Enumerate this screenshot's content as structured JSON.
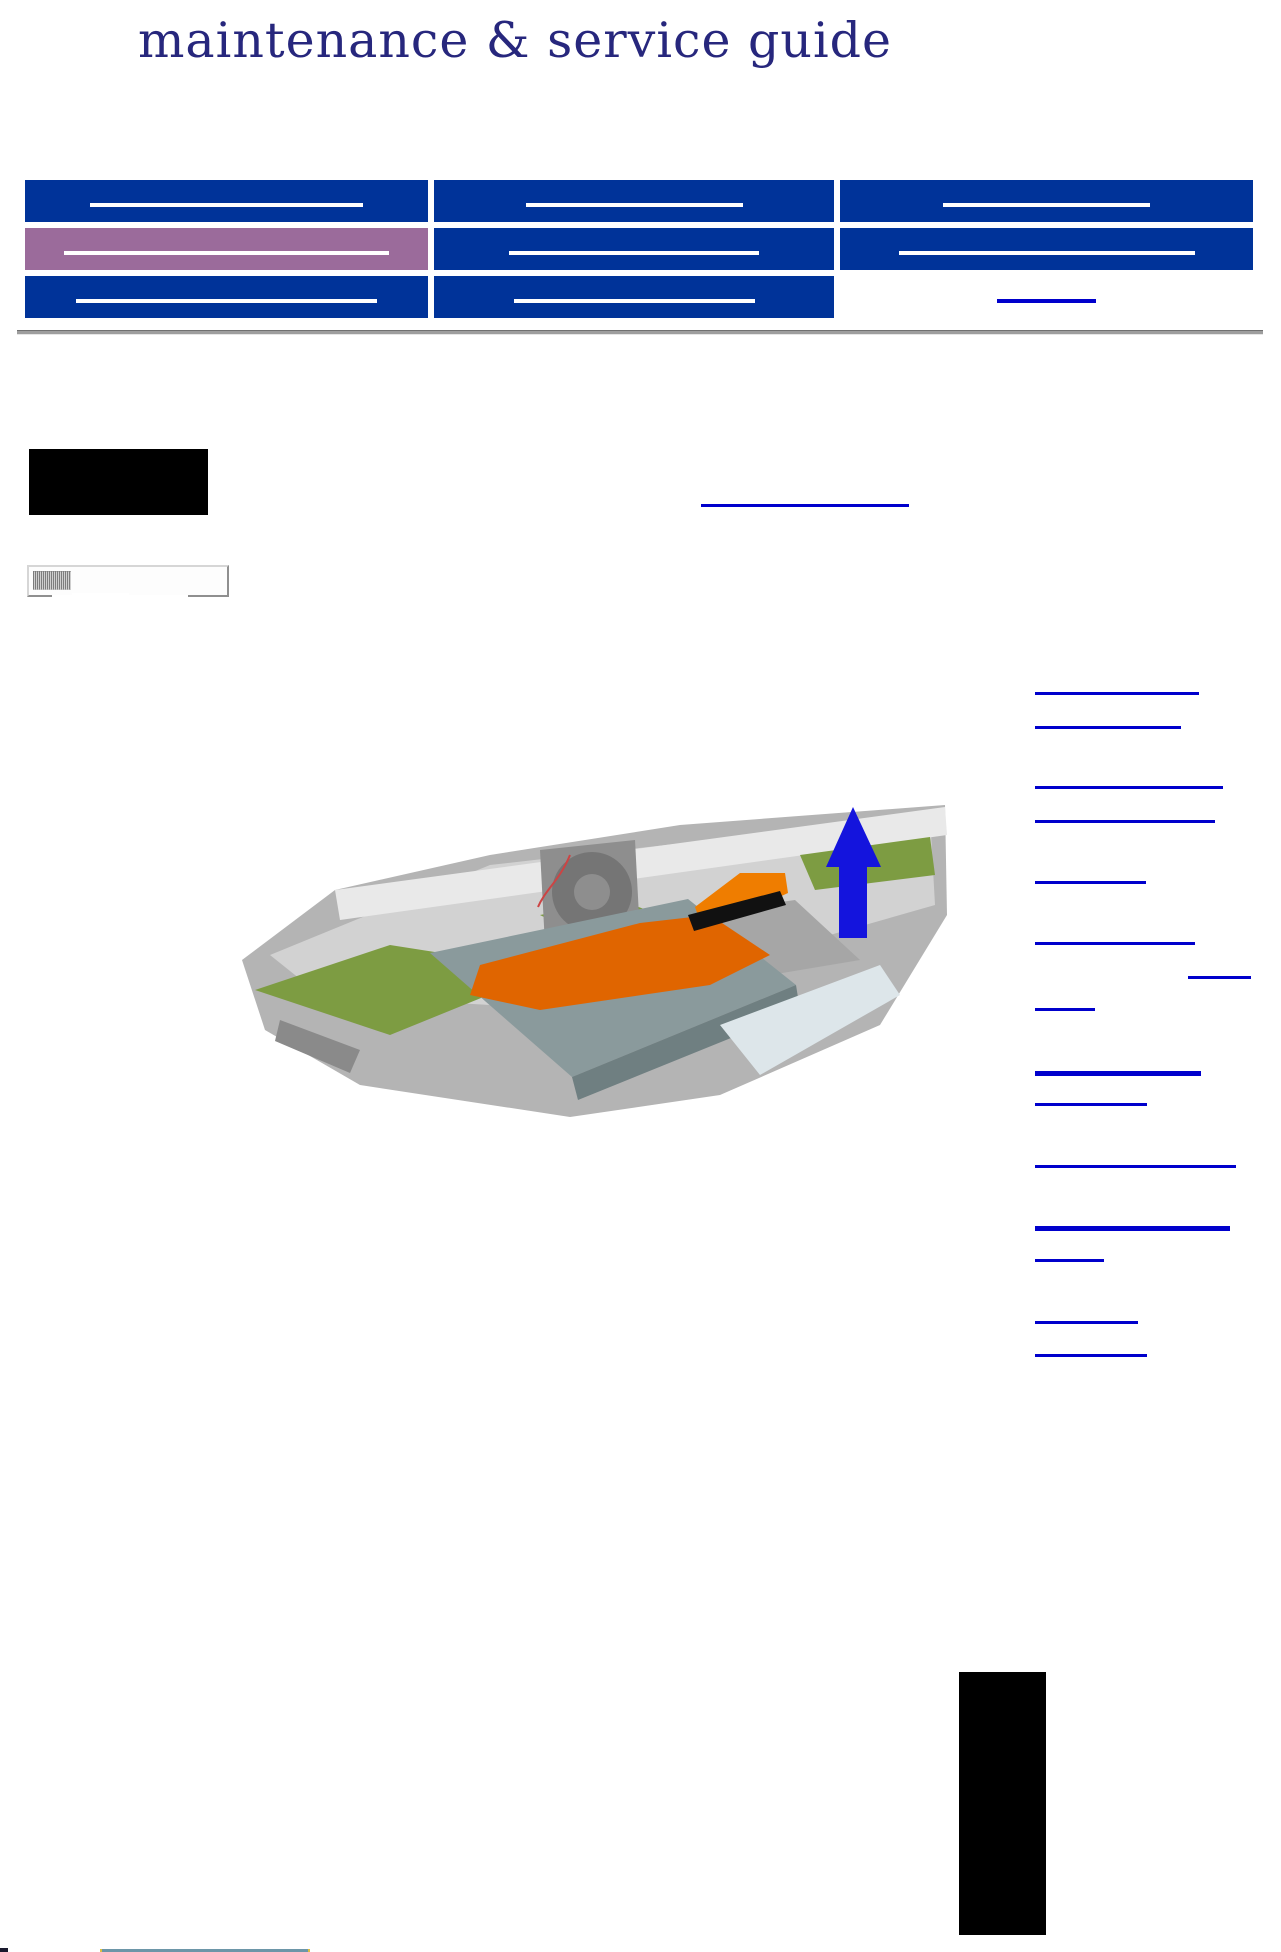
{
  "page": {
    "title": "maintenance & service guide",
    "title_color": "#27277d",
    "background": "#ffffff"
  },
  "colors": {
    "nav_blue": "#003399",
    "nav_purple": "#9b6b9b",
    "sidebar_purple": "#9b6b9b",
    "highlight_yellow": "#ffff66",
    "link_blue": "#0000cc",
    "underline_white": "#ffffff",
    "rule_gray": "#9e9e9e",
    "placeholder_black": "#000000"
  },
  "nav": {
    "col_widths": [
      403,
      400,
      413
    ],
    "row_height": 42,
    "rows": [
      {
        "cells": [
          {
            "bg": "#003399",
            "underline_color": "#ffffff",
            "underline_w": 273
          },
          {
            "bg": "#003399",
            "underline_color": "#ffffff",
            "underline_w": 217
          },
          {
            "bg": "#003399",
            "underline_color": "#ffffff",
            "underline_w": 207
          }
        ]
      },
      {
        "cells": [
          {
            "bg": "#9b6b9b",
            "underline_color": "#ffffff",
            "underline_w": 325
          },
          {
            "bg": "#003399",
            "underline_color": "#ffffff",
            "underline_w": 250
          },
          {
            "bg": "#003399",
            "underline_color": "#ffffff",
            "underline_w": 296
          }
        ]
      },
      {
        "cells": [
          {
            "bg": "#003399",
            "underline_color": "#ffffff",
            "underline_w": 301
          },
          {
            "bg": "#003399",
            "underline_color": "#ffffff",
            "underline_w": 241
          },
          {
            "bg": "transparent",
            "underline_color": "#0000cc",
            "underline_w": 99
          }
        ]
      }
    ]
  },
  "header_note": {
    "black_box": {
      "x": 29,
      "y": 449,
      "w": 179,
      "h": 66
    },
    "link": {
      "x": 701,
      "y": 504,
      "w": 208,
      "h": 3
    }
  },
  "sidebar": {
    "x": 27,
    "y": 565,
    "width": 202,
    "cells": [
      {
        "bg": "#ffffff",
        "h": 64,
        "underlines": []
      },
      {
        "bg": "#9b6b9b",
        "h": 72,
        "underlines": [
          {
            "o": 27,
            "w": 156
          },
          {
            "o": 59,
            "w": 152
          }
        ]
      },
      {
        "bg": "#9b6b9b",
        "h": 39,
        "underlines": [
          {
            "o": 26,
            "w": 173
          }
        ]
      },
      {
        "bg": "#9b6b9b",
        "h": 104,
        "underlines": [
          {
            "o": 26,
            "w": 128
          },
          {
            "o": 58,
            "w": 153
          },
          {
            "o": 91,
            "w": 141
          }
        ]
      },
      {
        "bg": "#9b6b9b",
        "h": 40,
        "underlines": [
          {
            "o": 26,
            "w": 183
          }
        ]
      },
      {
        "bg": "#9b6b9b",
        "h": 36,
        "underlines": [
          {
            "o": 23,
            "w": 130
          }
        ]
      },
      {
        "bg": "#9b6b9b",
        "h": 37,
        "underlines": [
          {
            "o": 23,
            "w": 134
          }
        ]
      },
      {
        "bg": "#9b6b9b",
        "h": 38,
        "underlines": [
          {
            "o": 25,
            "w": 146
          }
        ]
      },
      {
        "bg": "#9b6b9b",
        "h": 71,
        "underlines": [
          {
            "o": 25,
            "w": 104
          },
          {
            "o": 57,
            "w": 118
          }
        ]
      },
      {
        "bg": "#9b6b9b",
        "h": 105,
        "underlines": [
          {
            "o": 27,
            "w": 109
          },
          {
            "o": 59,
            "w": 115
          },
          {
            "o": 92,
            "w": 80
          }
        ]
      },
      {
        "bg": "#9b6b9b",
        "h": 38,
        "underlines": [
          {
            "o": 26,
            "w": 97
          }
        ]
      },
      {
        "bg": "#9b6b9b",
        "h": 72,
        "underlines": [
          {
            "o": 26,
            "w": 185
          },
          {
            "o": 59,
            "w": 129
          }
        ]
      },
      {
        "bg": "#9b6b9b",
        "h": 72,
        "underlines": [
          {
            "o": 26,
            "w": 152
          },
          {
            "o": 59,
            "w": 77
          }
        ]
      },
      {
        "bg": "#9b6b9b",
        "h": 71,
        "underlines": [
          {
            "o": 26,
            "w": 118
          },
          {
            "o": 58,
            "w": 129
          }
        ]
      },
      {
        "bg": "#ffff66",
        "h": 65,
        "underlines": []
      },
      {
        "bg": "#9b6b9b",
        "h": 67,
        "underlines": [
          {
            "o": 21,
            "w": 57
          },
          {
            "o": 55,
            "w": 129
          }
        ]
      },
      {
        "bg": "#9b6b9b",
        "h": 71,
        "underlines": [
          {
            "o": 24,
            "w": 107
          },
          {
            "o": 58,
            "w": 80
          }
        ]
      },
      {
        "bg": "#9b6b9b",
        "h": 70,
        "underlines": [
          {
            "o": 26,
            "w": 152
          },
          {
            "o": 58,
            "w": 111
          }
        ]
      },
      {
        "bg": "#9b6b9b",
        "h": 74,
        "underlines": [
          {
            "o": 27,
            "w": 117
          },
          {
            "o": 60,
            "w": 97
          }
        ]
      }
    ]
  },
  "right_links": {
    "default_x": 1035,
    "items": [
      {
        "y": 692,
        "w": 164,
        "h": 3
      },
      {
        "y": 726,
        "w": 146,
        "h": 3
      },
      {
        "y": 786,
        "w": 188,
        "h": 3
      },
      {
        "y": 820,
        "w": 180,
        "h": 3
      },
      {
        "y": 881,
        "w": 111,
        "h": 3
      },
      {
        "y": 942,
        "w": 160,
        "h": 3
      },
      {
        "y": 976,
        "w": 63,
        "h": 3,
        "x": 1188
      },
      {
        "y": 1008,
        "w": 60,
        "h": 3
      },
      {
        "y": 1071,
        "w": 166,
        "h": 5
      },
      {
        "y": 1103,
        "w": 112,
        "h": 3
      },
      {
        "y": 1165,
        "w": 201,
        "h": 3
      },
      {
        "y": 1226,
        "w": 195,
        "h": 5
      },
      {
        "y": 1259,
        "w": 69,
        "h": 3
      },
      {
        "y": 1321,
        "w": 103,
        "h": 3
      },
      {
        "y": 1354,
        "w": 112,
        "h": 3
      }
    ]
  },
  "illustration": {
    "x": 240,
    "y": 795,
    "w": 710,
    "h": 325,
    "colors": {
      "chassis_mid": "#b4b4b4",
      "chassis_light": "#d2d2d2",
      "rail_white": "#e9e9e9",
      "pcb_green": "#7d9c42",
      "fan_body": "#8e8e8e",
      "fan_dark": "#757575",
      "panel_gray": "#a6a6a6",
      "drive_top": "#8a9a9c",
      "drive_front": "#6f7f81",
      "ribbon_orange": "#e06500",
      "ribbon_orange_light": "#ef7d00",
      "connector_black": "#111111",
      "arrow_blue": "#1414dd",
      "wire_red": "#cc4444",
      "speckle_light": "#dde6ea",
      "vent_gray": "#8a8a8a"
    }
  },
  "footer": {
    "black_box": {
      "x": 959,
      "y": 1672,
      "w": 87,
      "h": 263
    },
    "corner_square": {
      "x": 0,
      "y": 1948,
      "w": 8,
      "h": 4,
      "color": "#1a1a2e"
    },
    "bar": {
      "x": 100,
      "y": 1949,
      "w": 206,
      "h": 3,
      "color": "#6d96a8"
    },
    "bar_tip_color": "#e0c040"
  }
}
